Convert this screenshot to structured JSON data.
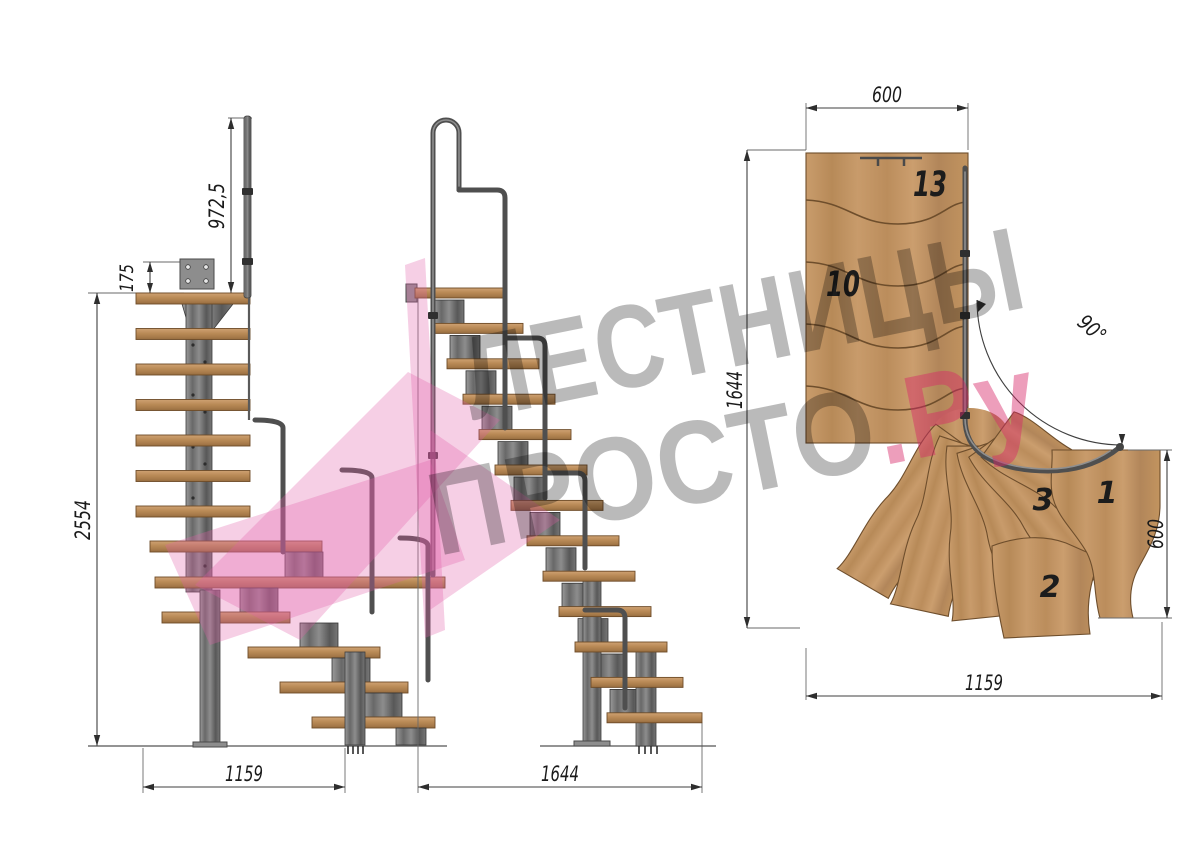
{
  "front_view": {
    "dim_rail_height": "972,5",
    "dim_plate_offset": "175",
    "dim_total_height": "2554",
    "dim_footprint_width": "1159"
  },
  "side_view": {
    "dim_total_length": "1644"
  },
  "plan_view": {
    "dim_flight_width": "600",
    "dim_total_length": "1644",
    "dim_turn_angle": "90°",
    "dim_lower_depth": "600",
    "dim_lower_length": "1159",
    "step_label_top": "13",
    "step_label_mid": "10",
    "step_label_third": "3",
    "step_label_first": "1",
    "step_label_second": "2"
  },
  "watermark": {
    "line1": "ЛЕСТНИЦЫ",
    "line2": "ПРОСТО",
    "suffix": ".Ру"
  },
  "colors": {
    "wood": "#c49463",
    "wood_dark": "#7a5a35",
    "metal": "#6e6e6e",
    "metal_dark": "#454545",
    "accent_pink": "#e0509b",
    "watermark_gray": "#b5b5b5"
  }
}
